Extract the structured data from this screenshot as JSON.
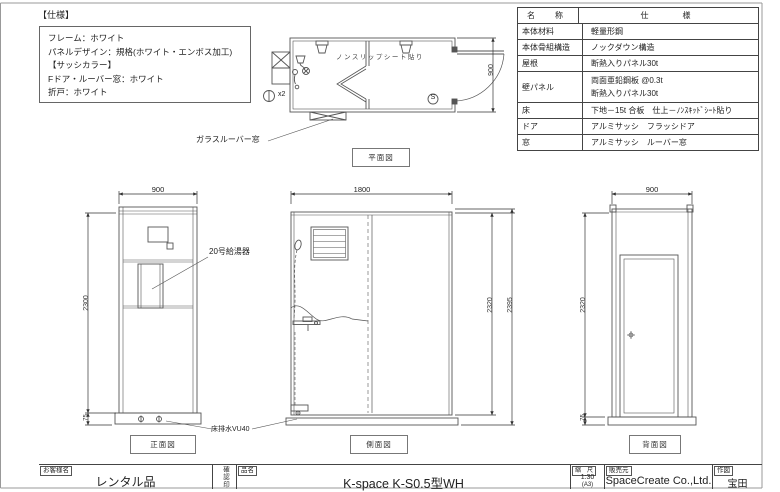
{
  "spec_note": {
    "title": "【仕様】",
    "lines": [
      "フレーム：ホワイト",
      "パネルデザイン：規格(ホワイト・エンボス加工)",
      "【サッシカラー】",
      "Fドア・ルーバー窓：ホワイト",
      "折戸：ホワイト"
    ]
  },
  "spec_table": {
    "header": {
      "name": "名　称",
      "spec": "仕　　様"
    },
    "rows": [
      {
        "name": "本体材料",
        "spec": "軽量形鋼"
      },
      {
        "name": "本体骨組構造",
        "spec": "ノックダウン構造"
      },
      {
        "name": "屋根",
        "spec": "断熱入りパネル30t"
      },
      {
        "name": "壁パネル",
        "spec": "両面亜鉛鋼板 @0.3t",
        "spec2": "断熱入りパネル30t"
      },
      {
        "name": "床",
        "spec": "下地－15t 合板　仕上－ﾉﾝｽｷｯﾄﾞｼｰﾄ貼り"
      },
      {
        "name": "ドア",
        "spec": "アルミサッシ　フラッシドア"
      },
      {
        "name": "窓",
        "spec": "アルミサッシ　ルーバー窓"
      }
    ]
  },
  "plan_view": {
    "label": "平面図",
    "nonslip": "ノンスリップシート貼り",
    "louver_window": "ガラスルーバー窓",
    "dim_depth": "900",
    "qty": "x2",
    "shower_symbol": "S"
  },
  "front_view": {
    "label": "正面図",
    "dim_width": "900",
    "dim_height": "2300",
    "dim_base": "75",
    "water_heater": "20号給湯器",
    "floor_drain": "床排水VU40"
  },
  "side_view": {
    "label": "側面図",
    "dim_width": "1800",
    "dim_height_inner": "2320",
    "dim_height_outer": "2395"
  },
  "rear_view": {
    "label": "背面図",
    "dim_width": "900",
    "dim_height": "2320",
    "dim_base": "75"
  },
  "title_block": {
    "customer_label": "お客様名",
    "customer": "レンタル品",
    "stamp_label": "確認印",
    "product_label": "品名",
    "product": "K-space K-S0.5型WH",
    "scale_label": "縮　尺",
    "scale": "1:30",
    "paper": "(A3)",
    "seller_label": "販売元",
    "seller": "SpaceCreate Co.,Ltd.",
    "author_label": "作図",
    "author": "宝田"
  }
}
